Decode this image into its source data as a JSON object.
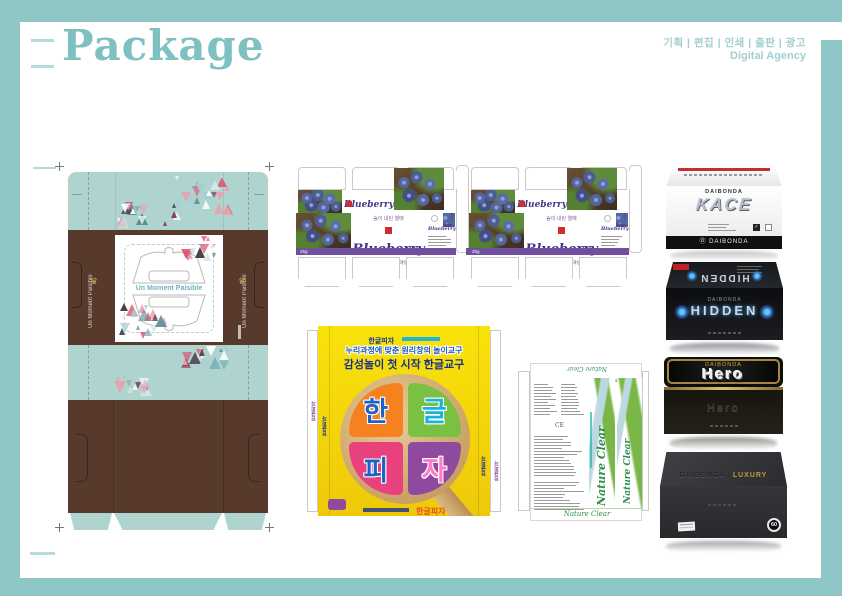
{
  "header": {
    "title": "Package",
    "services": "기획 | 편집 | 인쇄 | 출판 | 광고",
    "agency": "Digital Agency"
  },
  "un_moment": {
    "center_text": "Un Moment Paisible",
    "left_side_text": "Un Moment Paisible",
    "right_side_text": "Un Moment Paisible"
  },
  "blueberry": {
    "tagline": "숲이 내린 열매",
    "title": "Blueberry",
    "mini_title": "Blueberry",
    "option1": "아로니아야생블루베리",
    "option2": "블루베리",
    "weight": "25g"
  },
  "pizza": {
    "top_logo": "한글피자",
    "line1": "누리과정에 맞춘 원리창의 놀이교구",
    "line2": "감성놀이 첫 시작 한글교구",
    "slices": [
      "한",
      "글",
      "피",
      "자"
    ],
    "footer_label": "한글피자",
    "side_label": "한글피자"
  },
  "nature": {
    "top_label": "Nature Clear",
    "title": "Nature Clear",
    "brand": "BLOOMING",
    "ce_mark": "CE",
    "bottom_label": "Nature Clear"
  },
  "products": [
    {
      "brand": "DAIBONDA",
      "name": "KACE"
    },
    {
      "brand": "DAIBONDA",
      "name": "HIDDEN"
    },
    {
      "brand": "DAIBONDA",
      "name": "Hero"
    },
    {
      "brand": "DAIBONDA",
      "name": "LUXURY",
      "badge": "60"
    }
  ],
  "icons": {
    "check": "✓",
    "crown": "♛",
    "brand_mark": "Ⓓ"
  },
  "colors": {
    "frame_teal": "#8fc7c6",
    "title_teal": "#7ec1c0",
    "mint": "#afd4cf",
    "brown": "#583a2d",
    "blueberry_purple": "#473488",
    "stripe_purple": "#6f4f9e",
    "pizza_yellow": "#f6d90a",
    "pizza_navy": "#16338e",
    "nature_green": "#2f8f4f",
    "wave_blue": "#bcd9e2",
    "wave_green": "#7ab648",
    "gold": "#c8a23c",
    "glow_blue": "#2da8ff",
    "red": "#cf2e2e",
    "triangle_palette": [
      "#d9536e",
      "#8a3b52",
      "#433842",
      "#a9ccd6",
      "#7fb2bd",
      "#d9e8ea",
      "#5a8b98",
      "#e8a0b0",
      "#ffffff"
    ]
  }
}
